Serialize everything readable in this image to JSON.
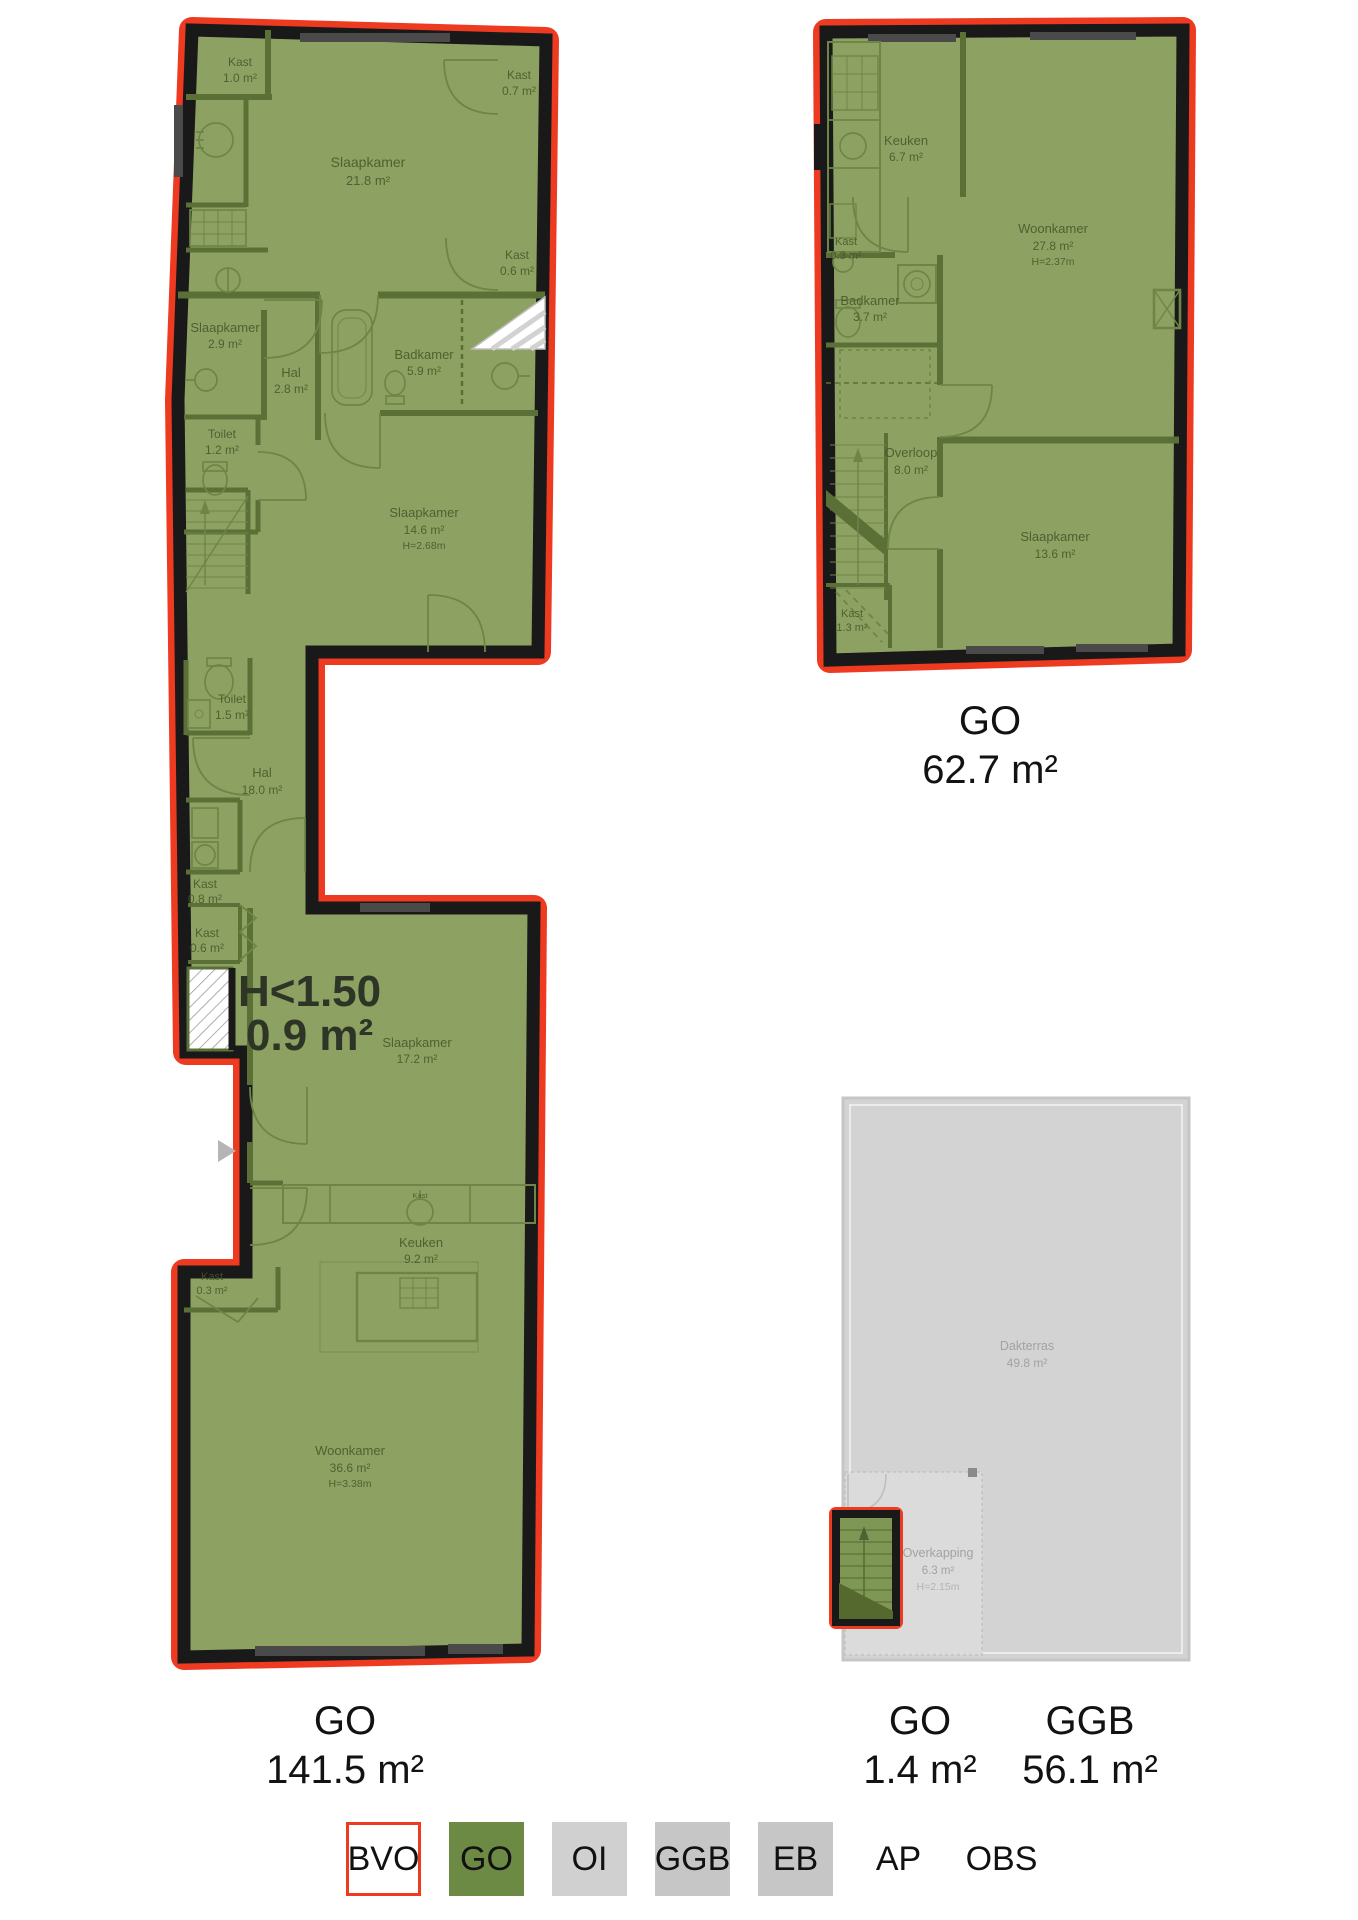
{
  "colors": {
    "bvo_outline_red": "#ee3a20",
    "go_green_fill": "#8da262",
    "go_legend_green": "#6c8a43",
    "wall_black": "#191919",
    "oi_gray": "#d0d0d0",
    "ggb_gray": "#c6c6c6",
    "eb_gray": "#c6c6c6",
    "roof_gray_fill": "#d3d3d3"
  },
  "left_plan": {
    "area_label": {
      "code": "GO",
      "value": "141.5 m²"
    },
    "low_height_note": {
      "line1": "H<1.50",
      "line2": "0.9 m²"
    },
    "rooms": [
      {
        "name": "Kast",
        "area": "1.0 m²"
      },
      {
        "name": "Slaapkamer",
        "area": "21.8 m²"
      },
      {
        "name": "Kast",
        "area": "0.7 m²"
      },
      {
        "name": "Kast",
        "area": "0.6 m²"
      },
      {
        "name": "Slaapkamer",
        "area": "2.9 m²"
      },
      {
        "name": "Hal",
        "area": "2.8 m²"
      },
      {
        "name": "Badkamer",
        "area": "5.9 m²"
      },
      {
        "name": "Toilet",
        "area": "1.2 m²"
      },
      {
        "name": "Slaapkamer",
        "area": "14.6 m²",
        "height": "H=2.68m"
      },
      {
        "name": "Toilet",
        "area": "1.5 m²"
      },
      {
        "name": "Hal",
        "area": "18.0 m²"
      },
      {
        "name": "Kast",
        "area": "0.8 m²"
      },
      {
        "name": "Kast",
        "area": "0.6 m²"
      },
      {
        "name": "Slaapkamer",
        "area": "17.2 m²"
      },
      {
        "name": "Kast",
        "area": ""
      },
      {
        "name": "Keuken",
        "area": "9.2 m²"
      },
      {
        "name": "Kast",
        "area": "0.3 m²"
      },
      {
        "name": "Woonkamer",
        "area": "36.6 m²",
        "height": "H=3.38m"
      }
    ]
  },
  "right_plan": {
    "area_label": {
      "code": "GO",
      "value": "62.7 m²"
    },
    "rooms": [
      {
        "name": "Keuken",
        "area": "6.7 m²"
      },
      {
        "name": "Woonkamer",
        "area": "27.8 m²",
        "height": "H=2.37m"
      },
      {
        "name": "Kast",
        "area": "0.3 m²"
      },
      {
        "name": "Badkamer",
        "area": "3.7 m²"
      },
      {
        "name": "Overloop",
        "area": "8.0 m²"
      },
      {
        "name": "Slaapkamer",
        "area": "13.6 m²"
      },
      {
        "name": "Kast",
        "area": "1.3 m²"
      }
    ]
  },
  "roof_plan": {
    "go_label": {
      "code": "GO",
      "value": "1.4 m²"
    },
    "ggb_label": {
      "code": "GGB",
      "value": "56.1 m²"
    },
    "rooms": [
      {
        "name": "Dakterras",
        "area": "49.8 m²"
      },
      {
        "name": "Overkapping",
        "area": "6.3 m²",
        "height": "H=2.15m"
      }
    ]
  },
  "legend": {
    "items": [
      {
        "label": "BVO"
      },
      {
        "label": "GO"
      },
      {
        "label": "OI"
      },
      {
        "label": "GGB"
      },
      {
        "label": "EB"
      },
      {
        "label": "AP"
      },
      {
        "label": "OBS"
      }
    ]
  }
}
